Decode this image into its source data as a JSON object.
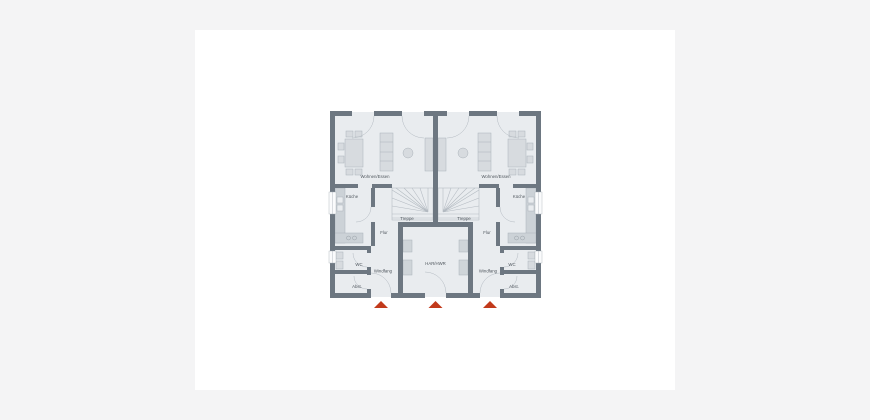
{
  "page": {
    "background_color": "#f4f4f5",
    "canvas_color": "#ffffff"
  },
  "floorplan": {
    "colors": {
      "wall": "#6d7781",
      "room_fill": "#e9ecef",
      "furniture_fill": "#d7dbdf",
      "counter_fill": "#ccd2d7",
      "appliance_fill": "#cfd5d9",
      "window_fill": "#fafbfc",
      "door_arc": "#b3bac1",
      "label_color": "#50575e",
      "entrance_marker_color": "#c23a1b"
    },
    "rooms": {
      "left_unit": {
        "living": "Wohnen/Essen",
        "kitchen": "Küche",
        "stairs": "Treppe",
        "hall": "Flur",
        "wc": "WC",
        "vestibule": "Windfang",
        "storage": "Abst."
      },
      "right_unit": {
        "living": "Wohnen/Essen",
        "kitchen": "Küche",
        "stairs": "Treppe",
        "hall": "Flur",
        "wc": "WC",
        "vestibule": "Windfang",
        "storage": "Abst."
      },
      "shared": {
        "utility": "HAR/HWR"
      }
    },
    "entrance_markers": {
      "count": 3,
      "shape": "triangle-up",
      "color": "#c23a1b"
    }
  }
}
